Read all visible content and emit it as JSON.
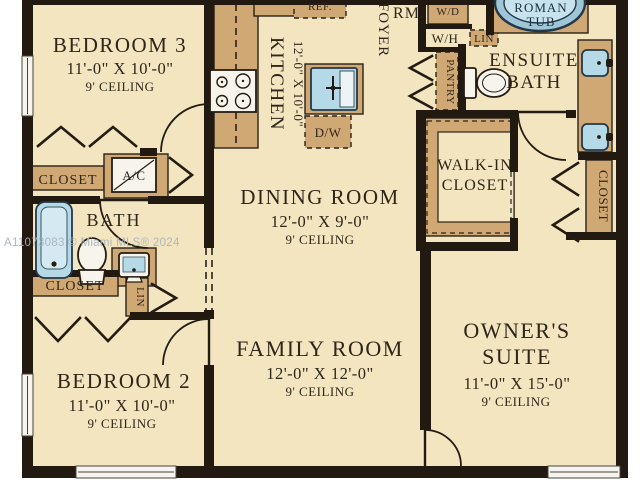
{
  "plan_title": "Residential floor plan",
  "watermark": "A11073083 © Miami MLS® 2024",
  "colors": {
    "floor": "#f2e5c0",
    "cabinetry_tan": "#cfa873",
    "wall_black": "#221a10",
    "fixture_blue": "#b5d9e6",
    "text_ink": "#2f2519",
    "watermark_gray": "#a9b2bc"
  },
  "rooms": {
    "bedroom3": {
      "name": "BEDROOM 3",
      "size": "11'-0\" X 10'-0\"",
      "ceiling": "9' CEILING"
    },
    "bedroom2": {
      "name": "BEDROOM 2",
      "size": "11'-0\" X 10'-0\"",
      "ceiling": "9' CEILING"
    },
    "dining": {
      "name": "DINING ROOM",
      "size": "12'-0\" X 9'-0\"",
      "ceiling": "9' CEILING"
    },
    "family": {
      "name": "FAMILY ROOM",
      "size": "12'-0\" X 12'-0\"",
      "ceiling": "9' CEILING"
    },
    "owners": {
      "name_line1": "OWNER'S",
      "name_line2": "SUITE",
      "size": "11'-0\" X 15'-0\"",
      "ceiling": "9' CEILING"
    },
    "kitchen": {
      "name": "KITCHEN",
      "size": "12'-0\" X 10'-0\""
    },
    "ensuite": {
      "name_line1": "ENSUITE",
      "name_line2": "BATH"
    },
    "bath": {
      "name": "BATH"
    },
    "foyer": {
      "name": "FOYER"
    },
    "walkin": {
      "name_line1": "WALK-IN",
      "name_line2": "CLOSET"
    }
  },
  "labels": {
    "closet_bedroom3": "CLOSET",
    "closet_bedroom2": "CLOSET",
    "closet_owner": "CLOSET",
    "ac": "A/C",
    "ref": "REF.",
    "dw": "D/W",
    "wd": "W/D",
    "wh": "W/H",
    "lin_hall": "LIN",
    "lin_bedroom": "LIN",
    "pantry": "PANTRY",
    "rm": "RM.",
    "roman_tub_line1": "ROMAN",
    "roman_tub_line2": "TUB"
  }
}
